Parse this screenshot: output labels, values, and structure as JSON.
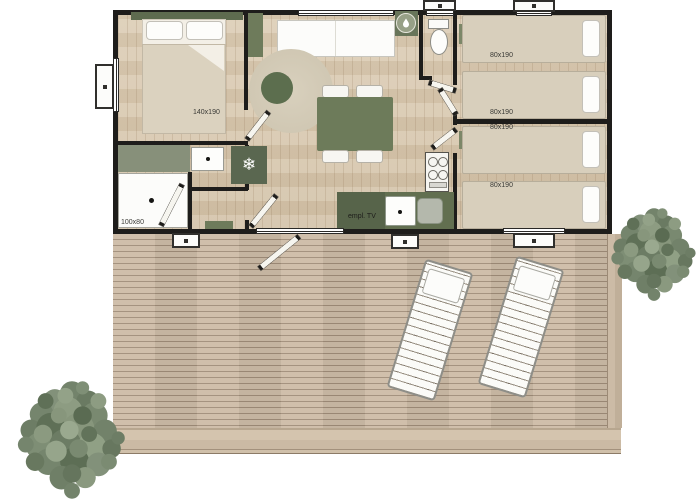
{
  "labels": {
    "master_bed": "140x190",
    "single_beds": [
      "80x190",
      "80x190",
      "80x190",
      "80x190"
    ],
    "shower": "100x80",
    "tv": "empl. TV"
  },
  "icons": {
    "fridge_snowflake": "❄"
  },
  "colors": {
    "wall": "#1e1d1b",
    "sage_dark": "#5e6b4f",
    "sage": "#74815f",
    "sage_light": "#87907a",
    "interior_floor": "#d9c9b1",
    "deck_wood": "#c8b7a2",
    "rug": "#d4ccb9",
    "bed_linen": "#d8cfbc",
    "tree_foliage": "#75846d"
  }
}
